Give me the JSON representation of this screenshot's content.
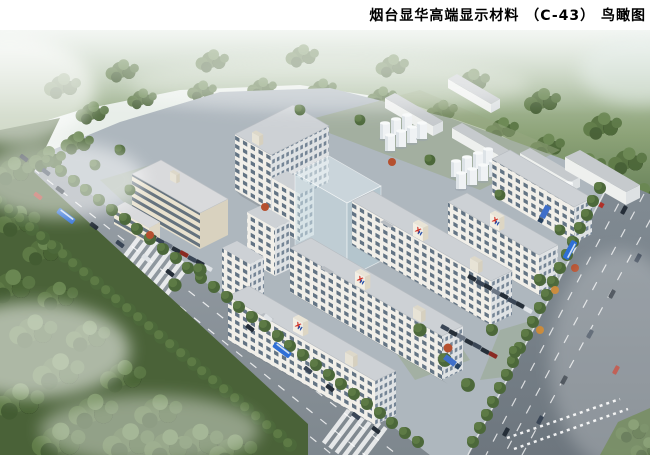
{
  "header": {
    "title": "烟台显华高端显示材料 （C-43） 鸟瞰图"
  },
  "scene": {
    "logo": {
      "x": "X",
      "h": "H"
    },
    "colors": {
      "logo_x": "#cf2b20",
      "logo_h": "#1d47a6",
      "road": "#868f96",
      "building_facade": "#f1efe9",
      "forest": "#52683c",
      "glass_massing": "#cfe3ea"
    }
  }
}
